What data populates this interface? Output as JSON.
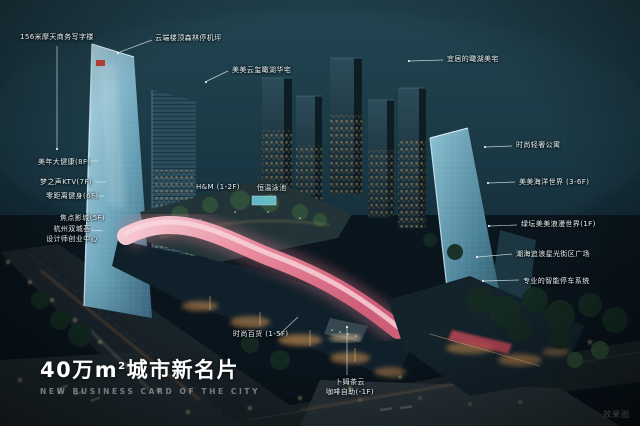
{
  "palette": {
    "sky_top": "#21424e",
    "sky_bottom": "#091620",
    "glass_blue": "#6aa2b8",
    "ribbon_pink": "#e8899c",
    "window_warm": "#f2b96f",
    "label_text": "#e9f2f6",
    "title_white": "#ffffff",
    "logo_red": "#c23b30"
  },
  "title": {
    "prefix": "40万m",
    "sup": "2",
    "suffix": "城市新名片",
    "subtitle": "NEW BUSINESS CARD OF THE CITY"
  },
  "watermark": "效果图",
  "annotations": [
    {
      "id": "office-tower",
      "text": "156米摩天商务写字楼"
    },
    {
      "id": "helipad",
      "text": "云端楼顶森林停机坪"
    },
    {
      "id": "lakeview-west",
      "text": "美美云玺瞰湖华宅"
    },
    {
      "id": "health-center",
      "text": "美年大健康(8F)"
    },
    {
      "id": "ktv",
      "text": "梦之声KTV(7F)"
    },
    {
      "id": "gym",
      "text": "零距离健身(6F)"
    },
    {
      "id": "cinema",
      "text": "焦点影城(5F)"
    },
    {
      "id": "designer-center",
      "text": "杭州双城荟\n设计师创业中心"
    },
    {
      "id": "hm-store",
      "text": "H&M (1-2F)"
    },
    {
      "id": "pool",
      "text": "恒温泳池"
    },
    {
      "id": "department-store",
      "text": "时尚百货 (1-5F)"
    },
    {
      "id": "cafe",
      "text": "卜姆茶云\n咖啡自助(-1F)"
    },
    {
      "id": "lakeview-east",
      "text": "宜居的瞰湖美宅"
    },
    {
      "id": "apartment",
      "text": "时尚轻奢公寓"
    },
    {
      "id": "ocean-world",
      "text": "美美海洋世界 (3-6F)"
    },
    {
      "id": "romantic-street",
      "text": "绿坛美美浪漫世界(1F)"
    },
    {
      "id": "plaza",
      "text": "潮海追浪星光街区广场"
    },
    {
      "id": "parking",
      "text": "专业的智能停车系统"
    }
  ]
}
